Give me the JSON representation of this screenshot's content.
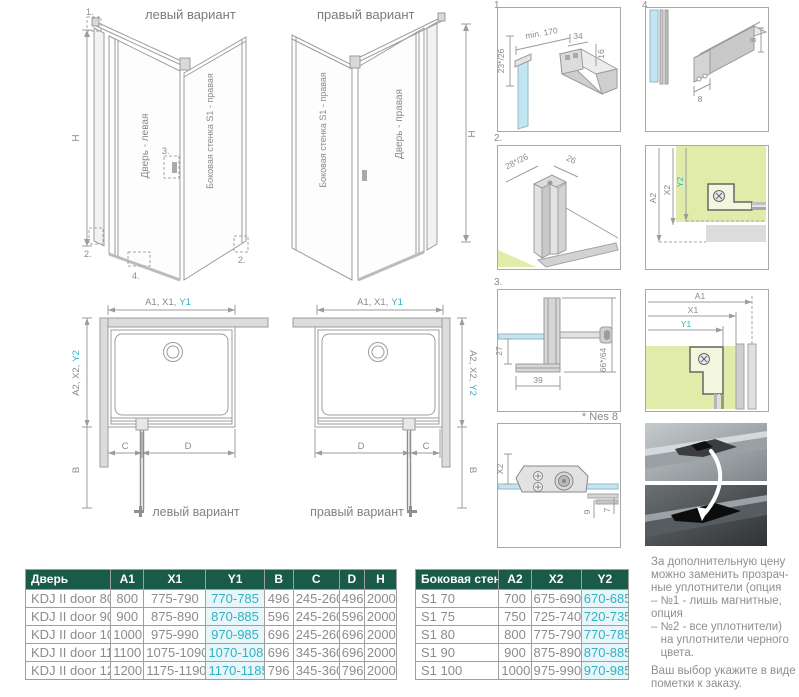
{
  "colors": {
    "teal": "#2fb3c4",
    "header_green": "#1a5a48",
    "glass_blue": "#c2e5f3",
    "wall_green": "#e2ecaa"
  },
  "iso_left": {
    "title": "левый вариант",
    "door_label": "Дверь - левая",
    "wall_label": "Боковая стенка S1 - правая",
    "h": "H",
    "callout_1": "1.",
    "callout_2": "2.",
    "callout_3": "3.",
    "callout_4": "4.",
    "callout_2b": "2."
  },
  "iso_right": {
    "title": "правый вариант",
    "door_label": "Дверь - правая",
    "wall_label": "Боковая стенка S1 - правая",
    "h": "H"
  },
  "plan_left": {
    "top_dims": "A1, X1,",
    "top_dims_teal": "Y1",
    "side_dims": "A2, X2,",
    "side_dims_teal": "Y2",
    "b": "B",
    "c": "C",
    "d": "D",
    "caption": "левый вариант"
  },
  "plan_right": {
    "top_dims": "A1, X1,",
    "top_dims_teal": "Y1",
    "side_dims": "A2, X2,",
    "side_dims_teal": "Y2",
    "b": "B",
    "c": "C",
    "d": "D",
    "caption": "правый вариант"
  },
  "details": {
    "label_1": "1.",
    "label_2": "2.",
    "label_3": "3.",
    "label_4": "4.",
    "d1": {
      "dim_left": "23*/26",
      "dim_top": "min. 170",
      "dim_bar": "34",
      "dim_right": "16"
    },
    "d4": {
      "dim_width": "8",
      "dim_height": "8"
    },
    "d2": {
      "dim_left": "28*/26",
      "dim_right": "26"
    },
    "corner2": {
      "a2": "A2",
      "x2": "X2",
      "y2": "Y2"
    },
    "d3": {
      "dim_left": "27",
      "dim_bottom": "39",
      "dim_right": "66*/64",
      "note": "* Nes 8"
    },
    "corner1": {
      "a1": "A1",
      "x1": "X1",
      "y1": "Y1"
    },
    "hinge": {
      "x2": "X2",
      "dim_9": "9",
      "dim_7": "7"
    }
  },
  "door_table": {
    "headers": [
      "Дверь",
      "A1",
      "X1",
      "Y1",
      "B",
      "C",
      "D",
      "H"
    ],
    "teal_col": 3,
    "rows": [
      [
        "KDJ II door 80",
        "800",
        "775-790",
        "770-785",
        "496",
        "245-260",
        "496",
        "2000"
      ],
      [
        "KDJ II door 90",
        "900",
        "875-890",
        "870-885",
        "596",
        "245-260",
        "596",
        "2000"
      ],
      [
        "KDJ II door 100",
        "1000",
        "975-990",
        "970-985",
        "696",
        "245-260",
        "696",
        "2000"
      ],
      [
        "KDJ II door 110",
        "1100",
        "1075-1090",
        "1070-1085",
        "696",
        "345-360",
        "696",
        "2000"
      ],
      [
        "KDJ II door 120",
        "1200",
        "1175-1190",
        "1170-1185",
        "796",
        "345-360",
        "796",
        "2000"
      ]
    ]
  },
  "wall_table": {
    "headers": [
      "Боковая стенка S1",
      "A2",
      "X2",
      "Y2"
    ],
    "teal_col": 3,
    "rows": [
      [
        "S1 70",
        "700",
        "675-690",
        "670-685"
      ],
      [
        "S1 75",
        "750",
        "725-740",
        "720-735"
      ],
      [
        "S1 80",
        "800",
        "775-790",
        "770-785"
      ],
      [
        "S1 90",
        "900",
        "875-890",
        "870-885"
      ],
      [
        "S1 100",
        "1000",
        "975-990",
        "970-985"
      ]
    ]
  },
  "note": {
    "p1": "За дополнительную цену\nможно заменить прозрач-\nные уплотнители (опция\n– №1 - лишь магнитные,\nопция\n– №2 - все уплотнители)\n   на уплотнители черного\n   цвета.",
    "p2": "Ваш выбор укажите в виде\nпометки к заказу."
  }
}
